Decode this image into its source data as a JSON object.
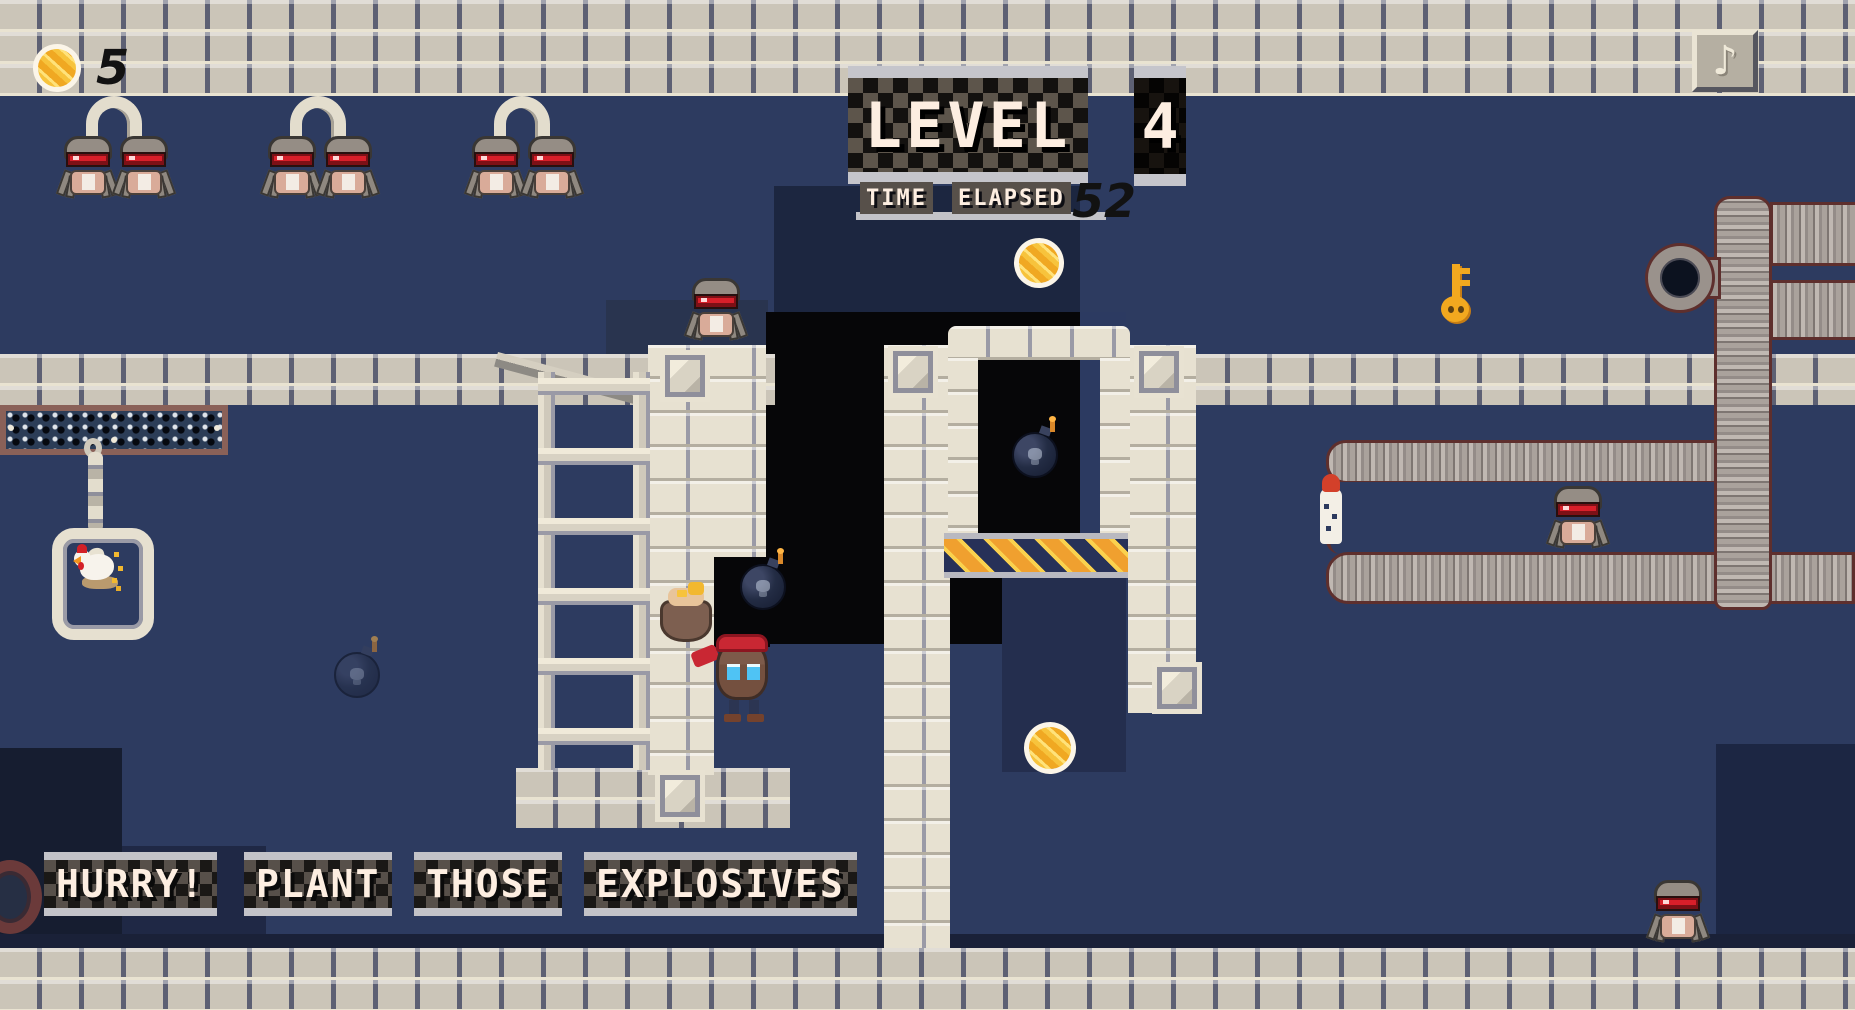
{
  "hud": {
    "coin_count": "5",
    "level_label": "LEVEL",
    "level_number": "4",
    "time_words": [
      "TIME",
      "ELAPSED"
    ],
    "time_value": "52",
    "music_icon": "♪",
    "message_words": [
      "HURRY!",
      "PLANT",
      "THOSE",
      "EXPLOSIVES"
    ]
  },
  "palette": {
    "background_navy": "#2d3b60",
    "pit_black": "#060608",
    "brick_light": "#cbc5b8",
    "masonry_cream": "#e7e1d1",
    "sign_body": "#5d554b",
    "sign_bar": "#c5c5cb",
    "text_cream": "#fdeee1",
    "robot_red": "#d81f2a",
    "gold": "#f2b82f",
    "hazard_orange": "#f0a02f",
    "tube_outline": "#5e2f2d"
  },
  "entities": {
    "arcs": [
      {
        "x": 86,
        "y": 96
      },
      {
        "x": 290,
        "y": 96
      },
      {
        "x": 494,
        "y": 96
      }
    ],
    "robots": [
      {
        "x": 62,
        "y": 136
      },
      {
        "x": 118,
        "y": 136
      },
      {
        "x": 266,
        "y": 136
      },
      {
        "x": 322,
        "y": 136
      },
      {
        "x": 470,
        "y": 136
      },
      {
        "x": 526,
        "y": 136
      },
      {
        "x": 690,
        "y": 278
      },
      {
        "x": 1552,
        "y": 486
      },
      {
        "x": 1652,
        "y": 880
      }
    ],
    "coins": [
      {
        "x": 1014,
        "y": 238,
        "size": 50
      },
      {
        "x": 1024,
        "y": 722,
        "size": 52
      }
    ],
    "bombs": [
      {
        "x": 1012,
        "y": 424,
        "variant": ""
      },
      {
        "x": 740,
        "y": 556,
        "variant": ""
      },
      {
        "x": 334,
        "y": 644,
        "variant": "faint"
      }
    ],
    "tiles": [
      {
        "x": 660,
        "y": 350
      },
      {
        "x": 888,
        "y": 346
      },
      {
        "x": 1134,
        "y": 346
      },
      {
        "x": 1152,
        "y": 662
      },
      {
        "x": 655,
        "y": 770
      }
    ]
  }
}
